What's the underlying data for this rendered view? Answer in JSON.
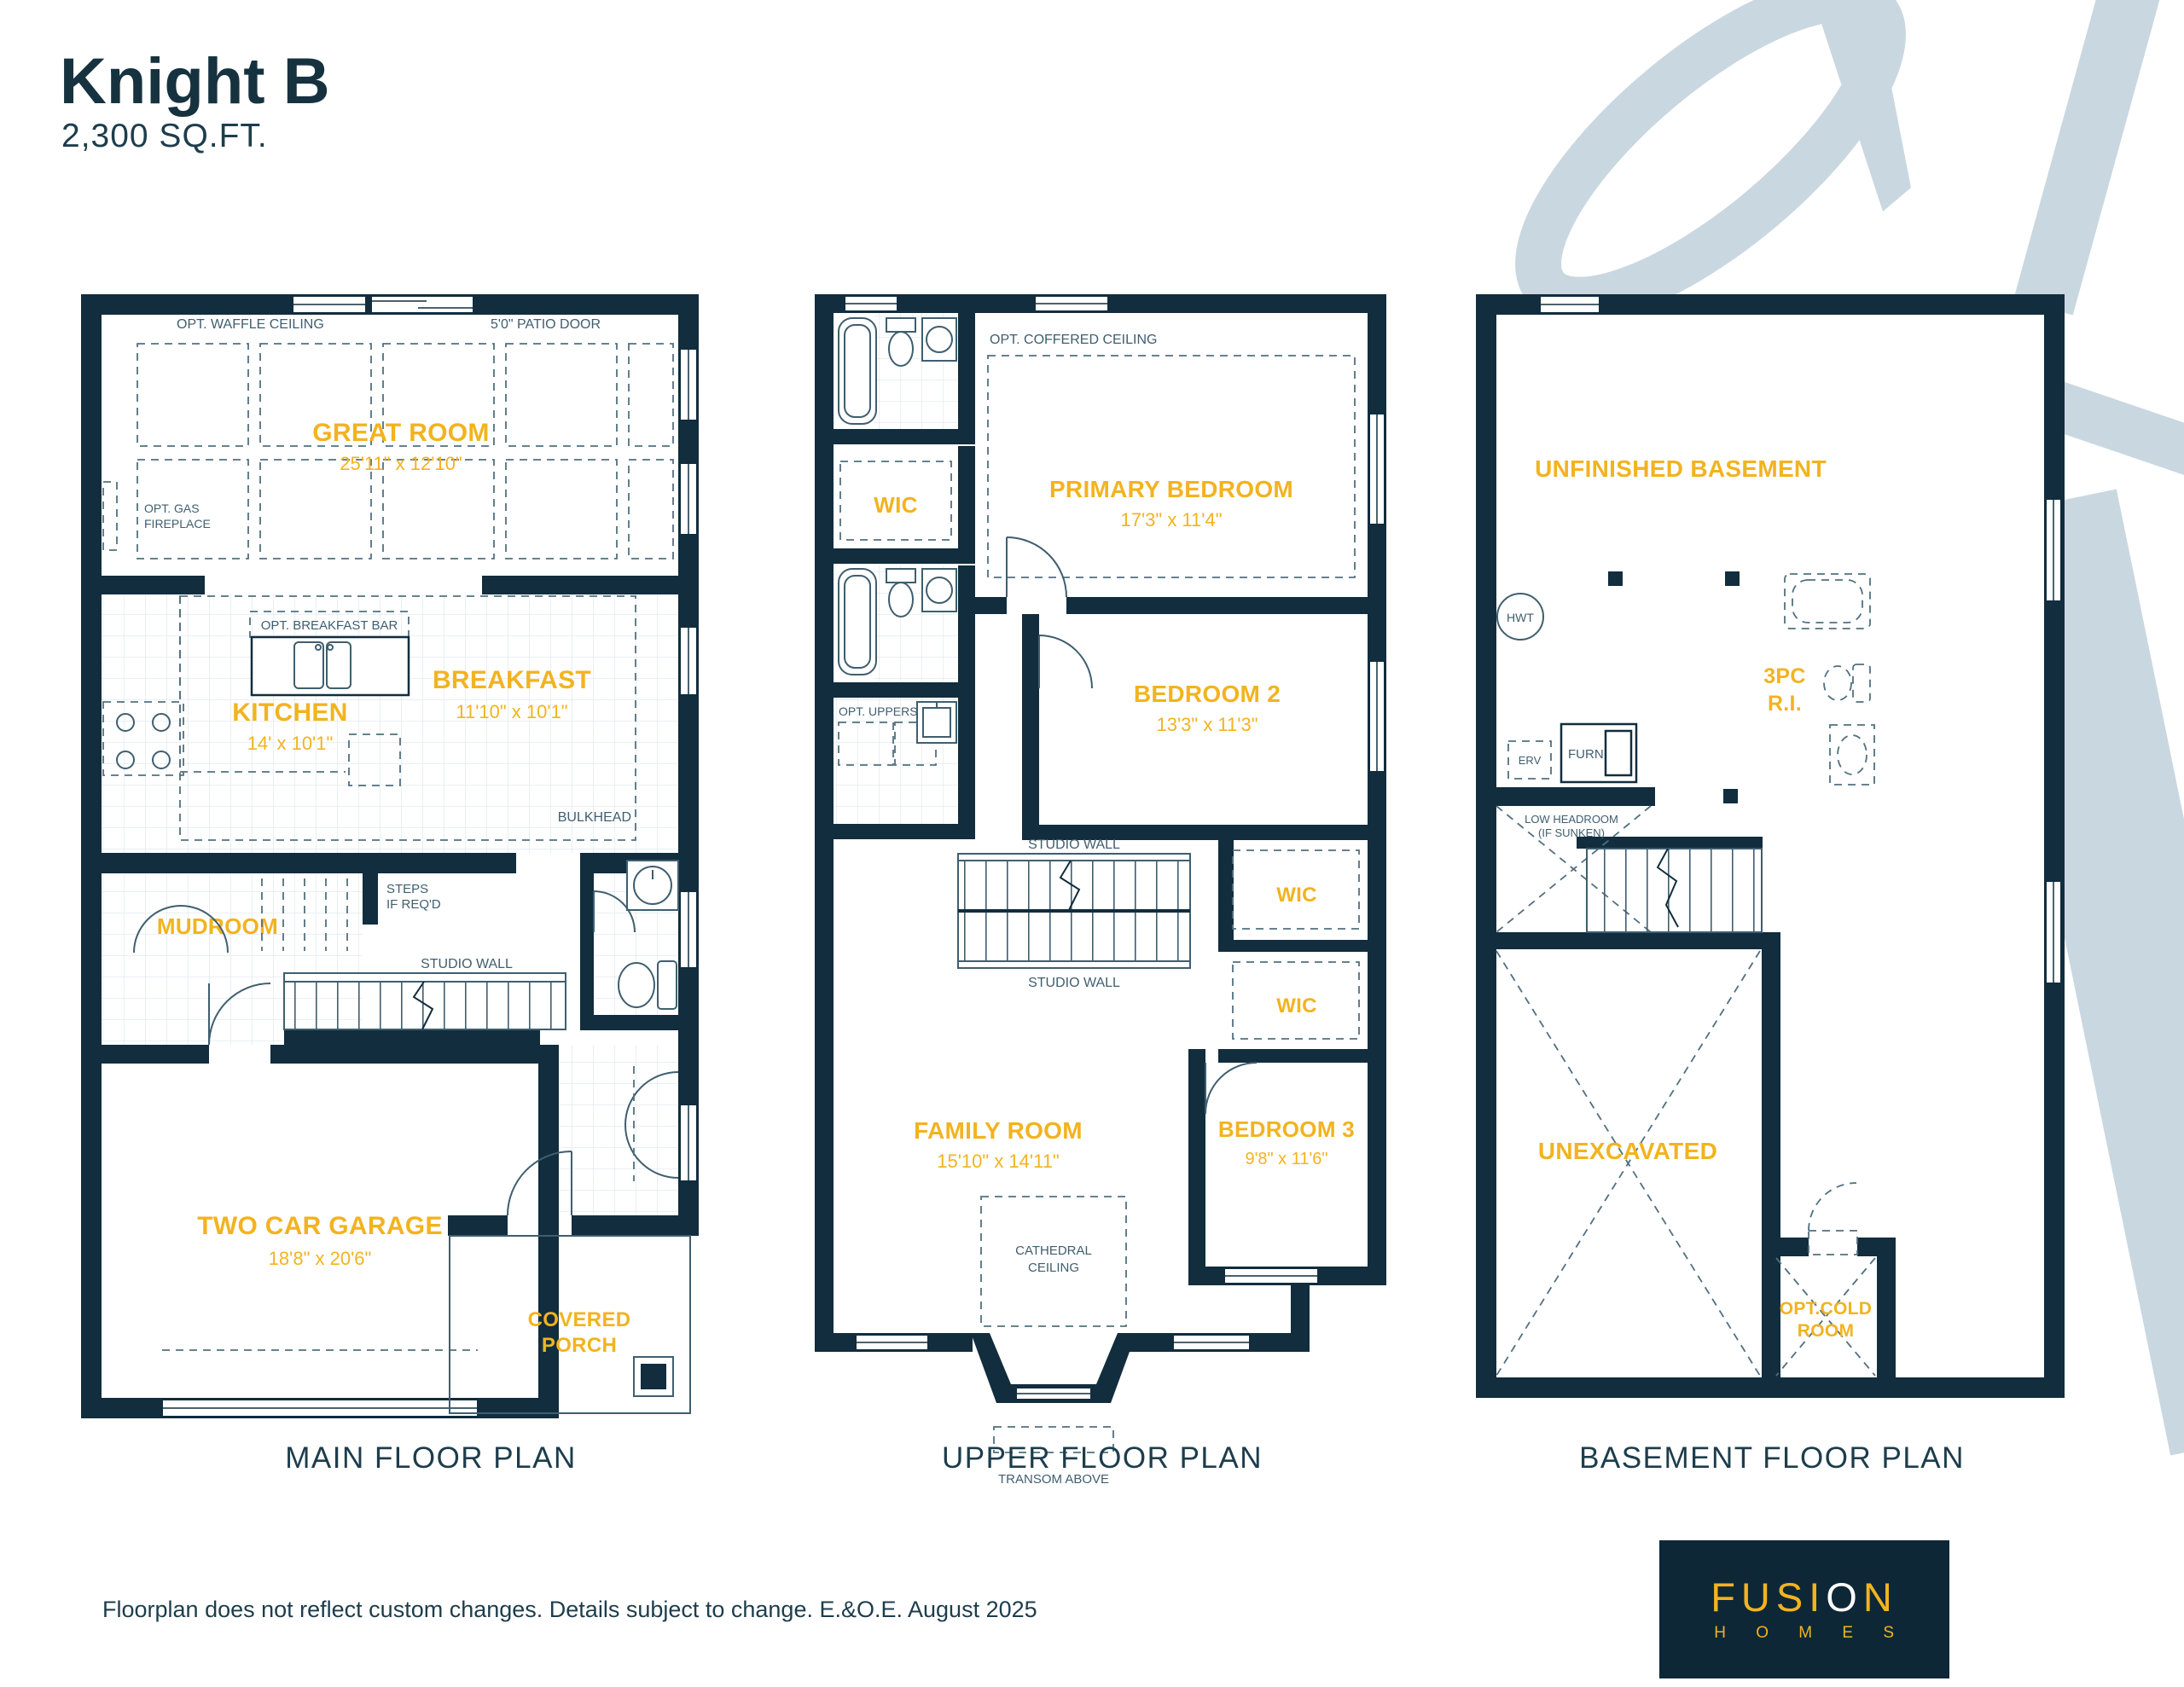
{
  "page": {
    "title": "Knight B",
    "sqft": "2,300 SQ.FT.",
    "disclaimer": "Floorplan does not reflect custom changes. Details subject to change. E.&O.E. August 2025"
  },
  "logo": {
    "fusi": "FUSI",
    "o": "O",
    "n": "N",
    "homes": "H O M E S"
  },
  "colors": {
    "navy": "#112d3e",
    "yellow": "#f2b31f",
    "swoosh": "#c9d7e0"
  },
  "plans": {
    "main": {
      "label": "MAIN FLOOR PLAN",
      "great_room_name": "GREAT ROOM",
      "great_room_dims": "25'11\" x 12'10\"",
      "kitchen_name": "KITCHEN",
      "kitchen_dims": "14' x 10'1\"",
      "breakfast_name": "BREAKFAST",
      "breakfast_dims": "11'10\" x 10'1\"",
      "mudroom_name": "MUDROOM",
      "garage_name": "TWO CAR GARAGE",
      "garage_dims": "18'8\" x 20'6\"",
      "porch_name_1": "COVERED",
      "porch_name_2": "PORCH",
      "ann_waffle": "OPT. WAFFLE CEILING",
      "ann_patio_door": "5'0\" PATIO DOOR",
      "ann_gas_1": "OPT. GAS",
      "ann_gas_2": "FIREPLACE",
      "ann_breakfast_bar": "OPT. BREAKFAST BAR",
      "ann_bulkhead": "BULKHEAD",
      "ann_steps_1": "STEPS",
      "ann_steps_2": "IF REQ'D",
      "ann_studio_wall": "STUDIO WALL"
    },
    "upper": {
      "label": "UPPER FLOOR PLAN",
      "primary_name": "PRIMARY BEDROOM",
      "primary_dims": "17'3\" x 11'4\"",
      "wic1": "WIC",
      "wic2": "WIC",
      "wic3": "WIC",
      "bedroom2_name": "BEDROOM 2",
      "bedroom2_dims": "13'3\" x 11'3\"",
      "bedroom3_name": "BEDROOM 3",
      "bedroom3_dims": "9'8\" x 11'6\"",
      "family_name": "FAMILY ROOM",
      "family_dims": "15'10\" x 14'11\"",
      "ann_coffered": "OPT. COFFERED CEILING",
      "ann_uppers": "OPT. UPPERS",
      "ann_studio_top": "STUDIO WALL",
      "ann_studio_bottom": "STUDIO WALL",
      "ann_cathedral_1": "CATHEDRAL",
      "ann_cathedral_2": "CEILING",
      "ann_transom": "TRANSOM ABOVE"
    },
    "basement": {
      "label": "BASEMENT FLOOR PLAN",
      "unfinished": "UNFINISHED BASEMENT",
      "hwt": "HWT",
      "threepc_1": "3PC",
      "threepc_2": "R.I.",
      "erv": "ERV",
      "furn": "FURN",
      "low_headroom_1": "LOW HEADROOM",
      "low_headroom_2": "(IF SUNKEN)",
      "unexcavated": "UNEXCAVATED",
      "cold_room_1": "OPT.COLD",
      "cold_room_2": "ROOM"
    }
  }
}
